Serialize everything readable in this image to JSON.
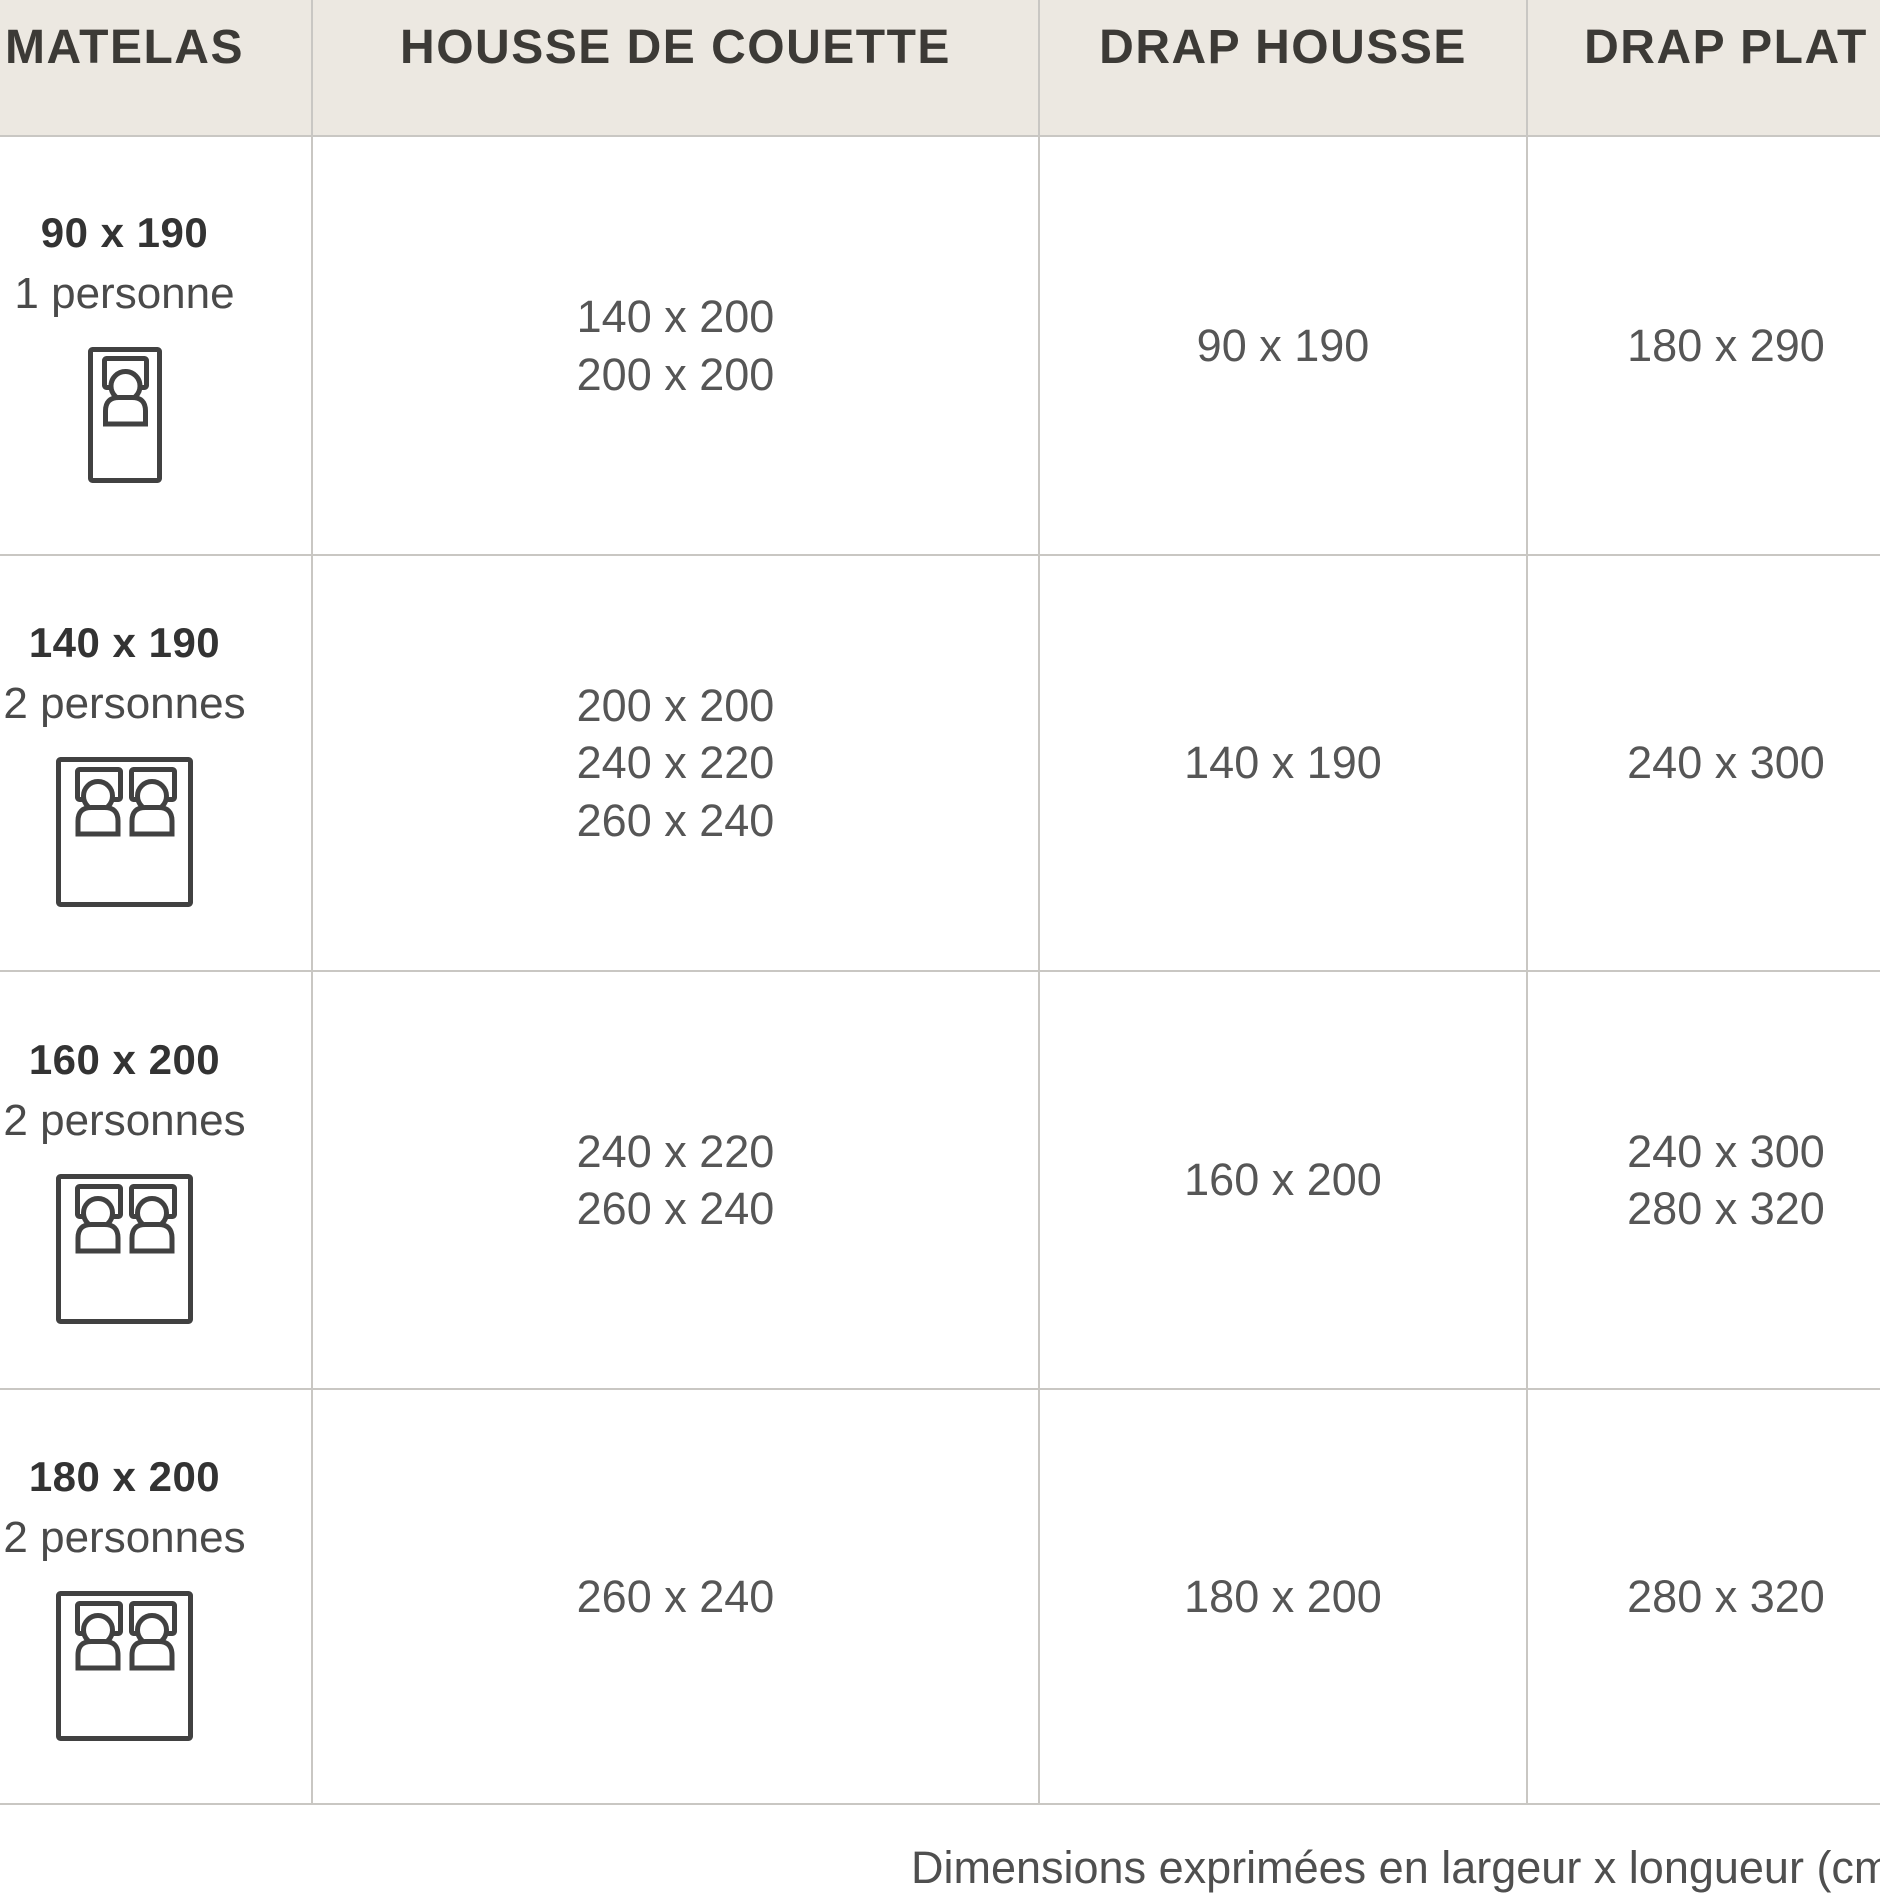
{
  "table": {
    "columns": [
      {
        "label": "MATELAS"
      },
      {
        "label": "HOUSSE DE COUETTE"
      },
      {
        "label": "DRAP HOUSSE"
      },
      {
        "label": "DRAP PLAT"
      }
    ],
    "rows": [
      {
        "mattress_size": "90 x 190",
        "capacity": "1 personne",
        "icon": "single-bed-icon",
        "duvet_cover": [
          "140 x 200",
          "200 x 200"
        ],
        "fitted_sheet": [
          "90 x 190"
        ],
        "flat_sheet": [
          "180 x 290"
        ]
      },
      {
        "mattress_size": "140 x 190",
        "capacity": "2 personnes",
        "icon": "double-bed-icon",
        "duvet_cover": [
          "200 x 200",
          "240 x 220",
          "260 x 240"
        ],
        "fitted_sheet": [
          "140 x 190"
        ],
        "flat_sheet": [
          "240 x 300"
        ]
      },
      {
        "mattress_size": "160 x 200",
        "capacity": "2 personnes",
        "icon": "double-bed-icon",
        "duvet_cover": [
          "240 x 220",
          "260 x 240"
        ],
        "fitted_sheet": [
          "160 x 200"
        ],
        "flat_sheet": [
          "240 x 300",
          "280 x 320"
        ]
      },
      {
        "mattress_size": "180 x 200",
        "capacity": "2 personnes",
        "icon": "double-bed-icon",
        "duvet_cover": [
          "260 x 240"
        ],
        "fitted_sheet": [
          "180 x 200"
        ],
        "flat_sheet": [
          "280 x 320"
        ]
      }
    ]
  },
  "footer": {
    "note": "Dimensions exprimées en largeur x longueur (cm"
  },
  "colors": {
    "header_bg": "#ECE8E1",
    "border": "#C9C7C3",
    "header_text": "#3C3A36",
    "size_text": "#333333",
    "capacity_text": "#4A4A4A",
    "value_text": "#565656",
    "footer_text": "#4F4F4F",
    "icon_stroke": "#414141"
  }
}
